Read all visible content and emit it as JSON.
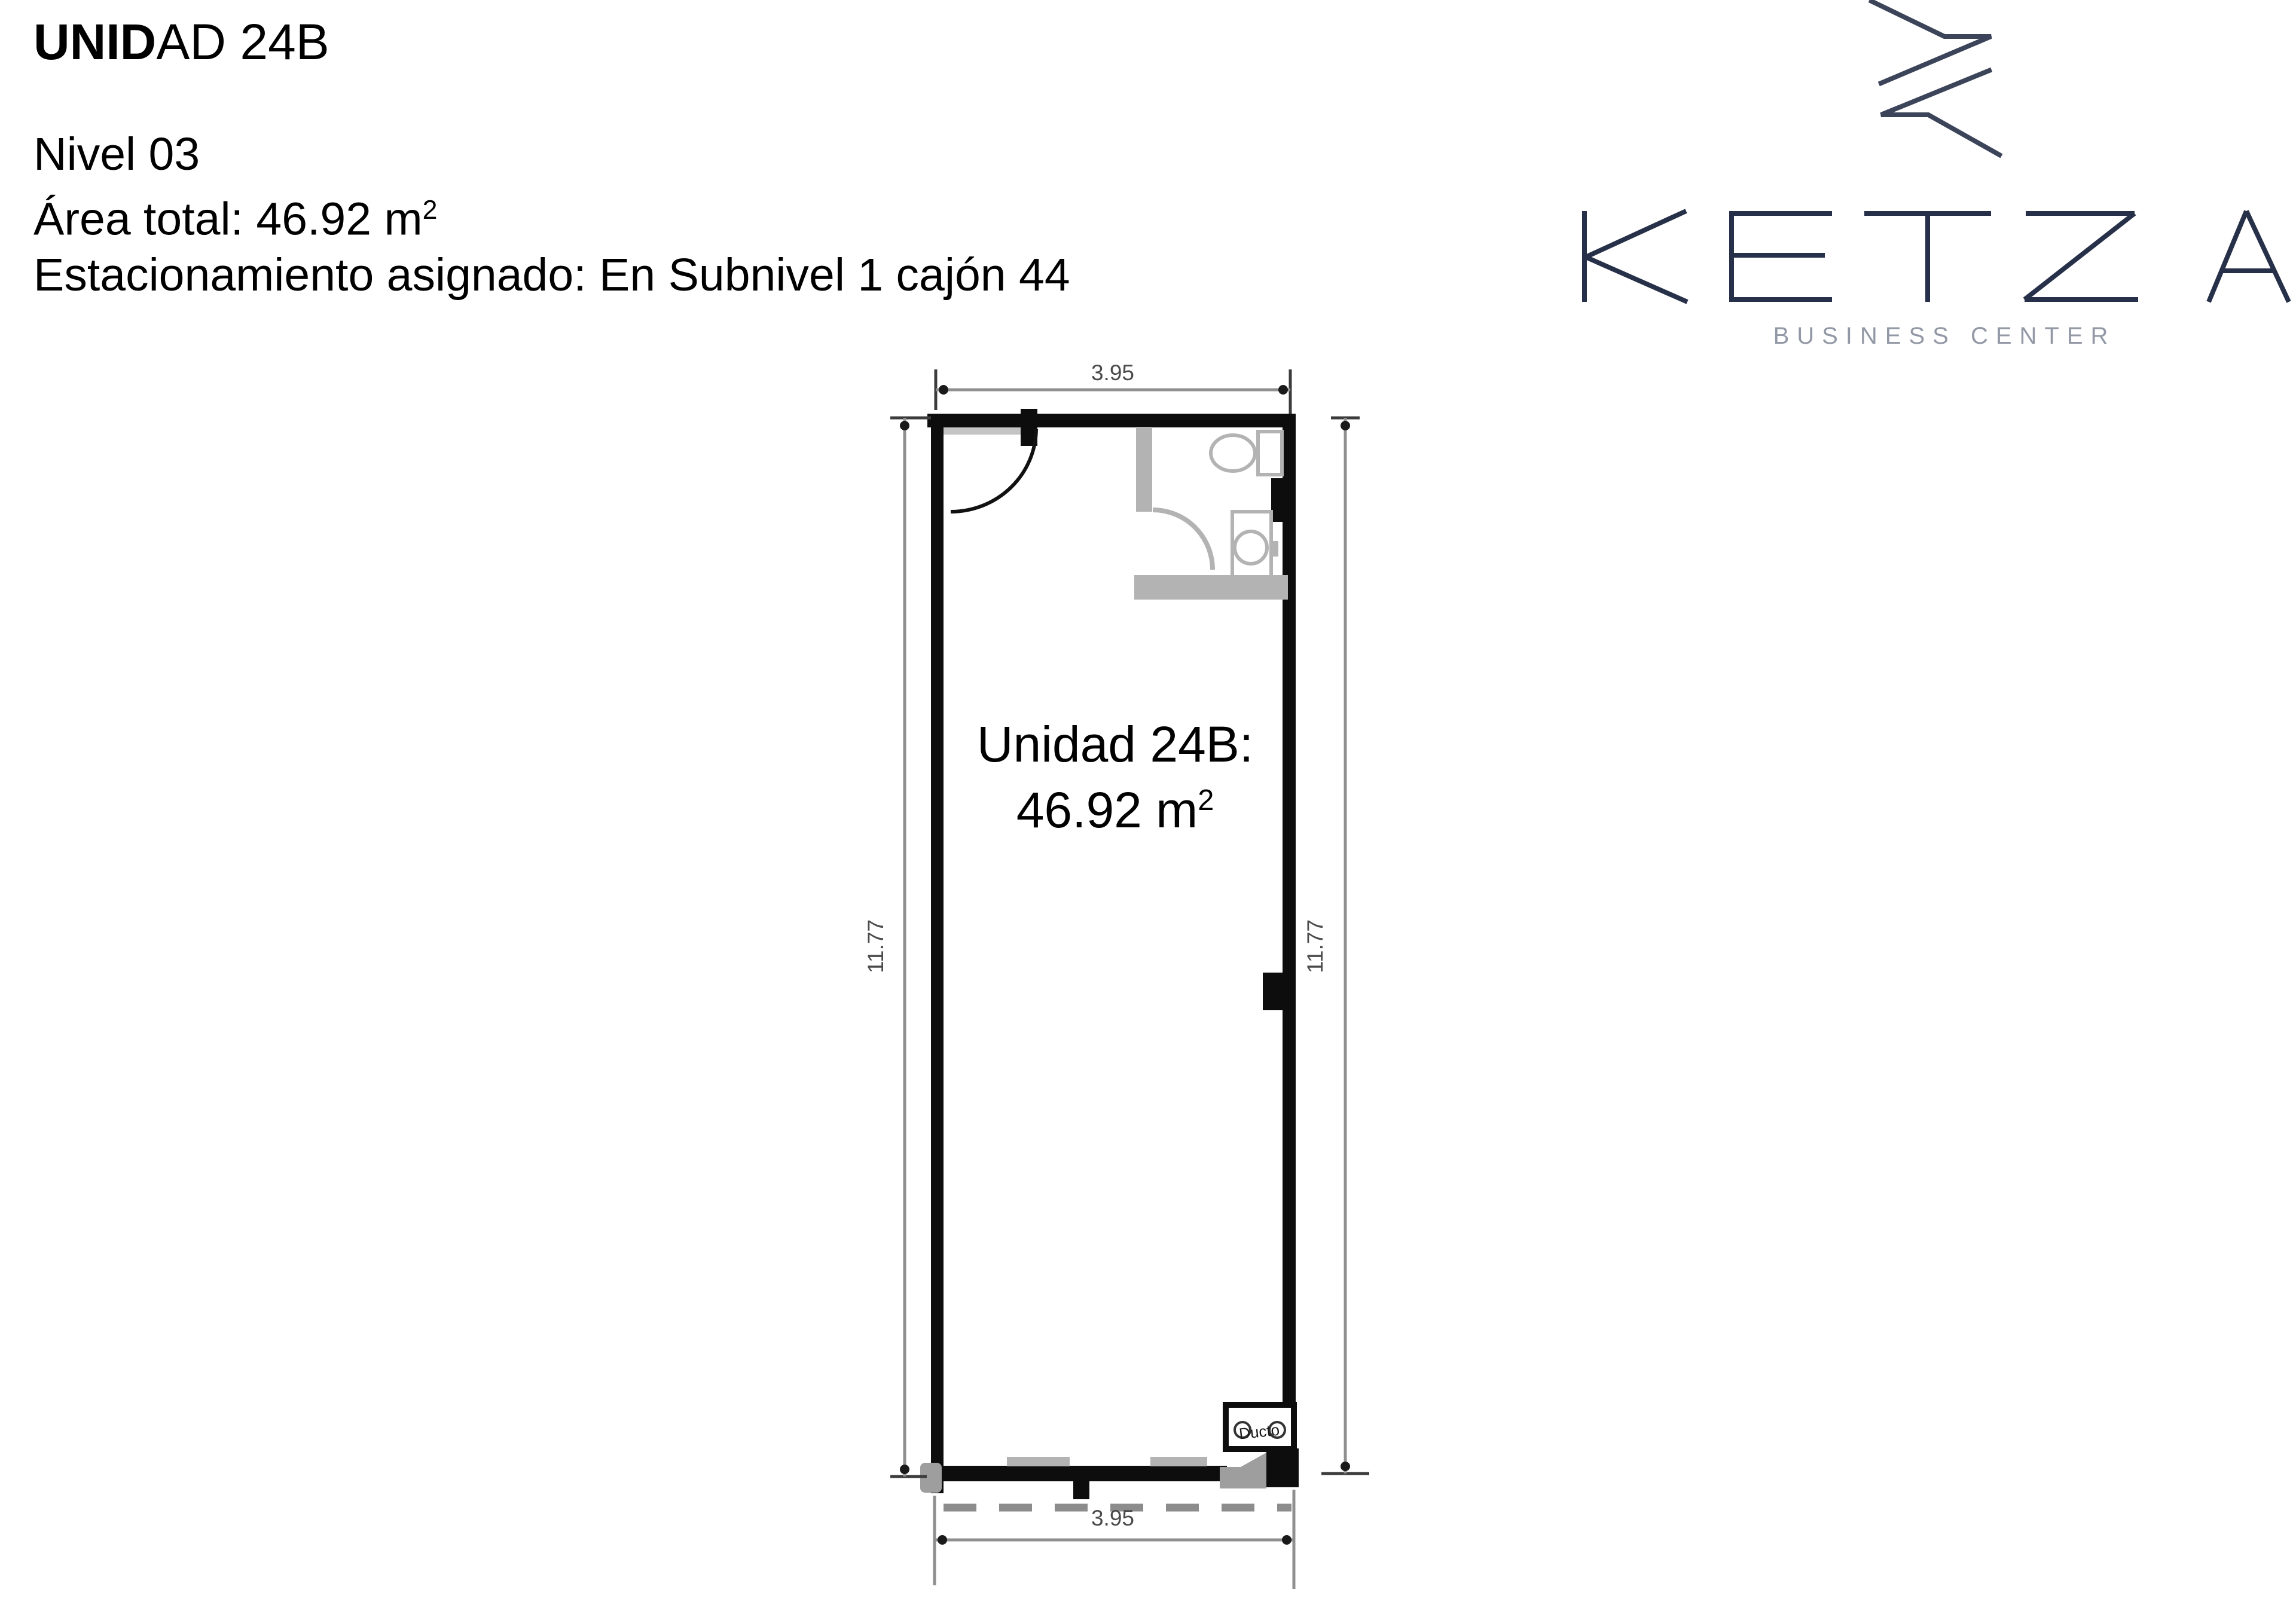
{
  "header": {
    "title": {
      "bold": "UNID",
      "rest": "AD 24B"
    },
    "level": "Nivel 03",
    "area_prefix": "Área total: 46.92 m",
    "area_exponent": "2",
    "parking": "Estacionamiento asignado: En Subnivel 1 cajón 44"
  },
  "logo": {
    "wordmark": "KETZA",
    "tagline": "BUSINESS CENTER"
  },
  "plan": {
    "room_label_line1": "Unidad 24B:",
    "room_area_prefix": "46.92 m",
    "room_area_exponent": "2",
    "duct_label": "Ducto",
    "dim_top": "3.95",
    "dim_bottom": "3.95",
    "dim_left": "11.77",
    "dim_right": "11.77"
  },
  "colors": {
    "wall_black": "#0d0d0d",
    "fixture_gray": "#b3b3b3",
    "mid_gray": "#9e9e9e",
    "glass_dash_gray": "#8c8c8c",
    "dim_line_gray": "#8f8f8f",
    "dim_tick_dark": "#3c3c3c",
    "dim_text_gray": "#4a4a4a",
    "logo_navy": "#273049",
    "logo_mark_navy": "#3c445a",
    "logo_tagline_gray": "#9298a5"
  }
}
